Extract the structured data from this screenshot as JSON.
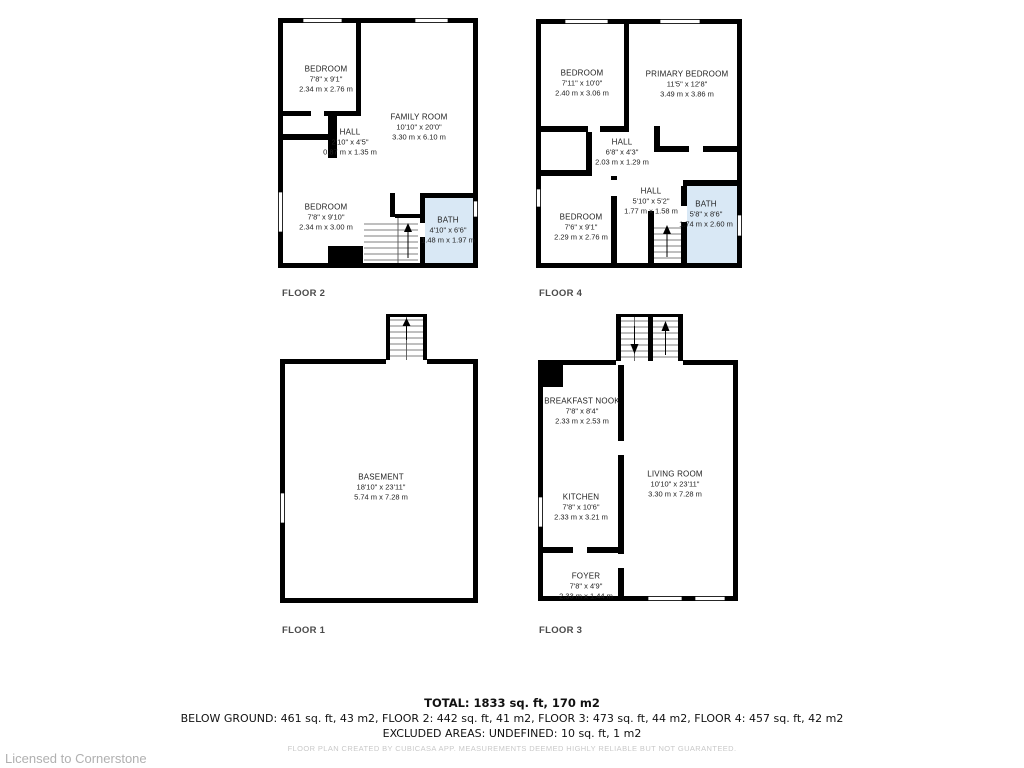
{
  "colors": {
    "wall": "#000000",
    "bath": "#d9e8f5"
  },
  "floors": [
    {
      "label": "FLOOR 2",
      "rooms": [
        {
          "name": "BEDROOM",
          "imperial": "7'8\" x 9'1\"",
          "metric": "2.34 m x 2.76 m"
        },
        {
          "name": "FAMILY ROOM",
          "imperial": "10'10\" x 20'0\"",
          "metric": "3.30 m x 6.10 m"
        },
        {
          "name": "HALL",
          "imperial": "2'10\" x 4'5\"",
          "metric": "0.87 m x 1.35 m"
        },
        {
          "name": "BEDROOM",
          "imperial": "7'8\" x 9'10\"",
          "metric": "2.34 m x 3.00 m"
        },
        {
          "name": "BATH",
          "imperial": "4'10\" x 6'6\"",
          "metric": "1.48 m x 1.97 m"
        }
      ]
    },
    {
      "label": "FLOOR 4",
      "rooms": [
        {
          "name": "BEDROOM",
          "imperial": "7'11\" x 10'0\"",
          "metric": "2.40 m x 3.06 m"
        },
        {
          "name": "PRIMARY BEDROOM",
          "imperial": "11'5\" x 12'8\"",
          "metric": "3.49 m x 3.86 m"
        },
        {
          "name": "HALL",
          "imperial": "6'8\" x 4'3\"",
          "metric": "2.03 m x 1.29 m"
        },
        {
          "name": "HALL",
          "imperial": "5'10\" x 5'2\"",
          "metric": "1.77 m x 1.58 m"
        },
        {
          "name": "BEDROOM",
          "imperial": "7'6\" x 9'1\"",
          "metric": "2.29 m x 2.76 m"
        },
        {
          "name": "BATH",
          "imperial": "5'8\" x 8'6\"",
          "metric": "1.74 m x 2.60 m"
        }
      ]
    },
    {
      "label": "FLOOR 1",
      "rooms": [
        {
          "name": "BASEMENT",
          "imperial": "18'10\" x 23'11\"",
          "metric": "5.74 m x 7.28 m"
        }
      ]
    },
    {
      "label": "FLOOR 3",
      "rooms": [
        {
          "name": "BREAKFAST NOOK",
          "imperial": "7'8\" x 8'4\"",
          "metric": "2.33 m x 2.53 m"
        },
        {
          "name": "KITCHEN",
          "imperial": "7'8\" x 10'6\"",
          "metric": "2.33 m x 3.21 m"
        },
        {
          "name": "LIVING ROOM",
          "imperial": "10'10\" x 23'11\"",
          "metric": "3.30 m x 7.28 m"
        },
        {
          "name": "FOYER",
          "imperial": "7'8\" x 4'9\"",
          "metric": "2.33 m x 1.44 m"
        }
      ]
    }
  ],
  "summary": {
    "total": "TOTAL: 1833 sq. ft, 170 m2",
    "floors": "BELOW GROUND: 461 sq. ft, 43 m2, FLOOR 2: 442 sq. ft, 41 m2, FLOOR 3: 473 sq. ft, 44 m2, FLOOR 4: 457 sq. ft, 42 m2",
    "excluded": "EXCLUDED AREAS: UNDEFINED: 10 sq. ft, 1 m2"
  },
  "footer": {
    "disclaimer": "FLOOR PLAN CREATED BY CUBICASA APP. MEASUREMENTS DEEMED HIGHLY RELIABLE BUT NOT GUARANTEED.",
    "license": "Licensed to Cornerstone"
  }
}
